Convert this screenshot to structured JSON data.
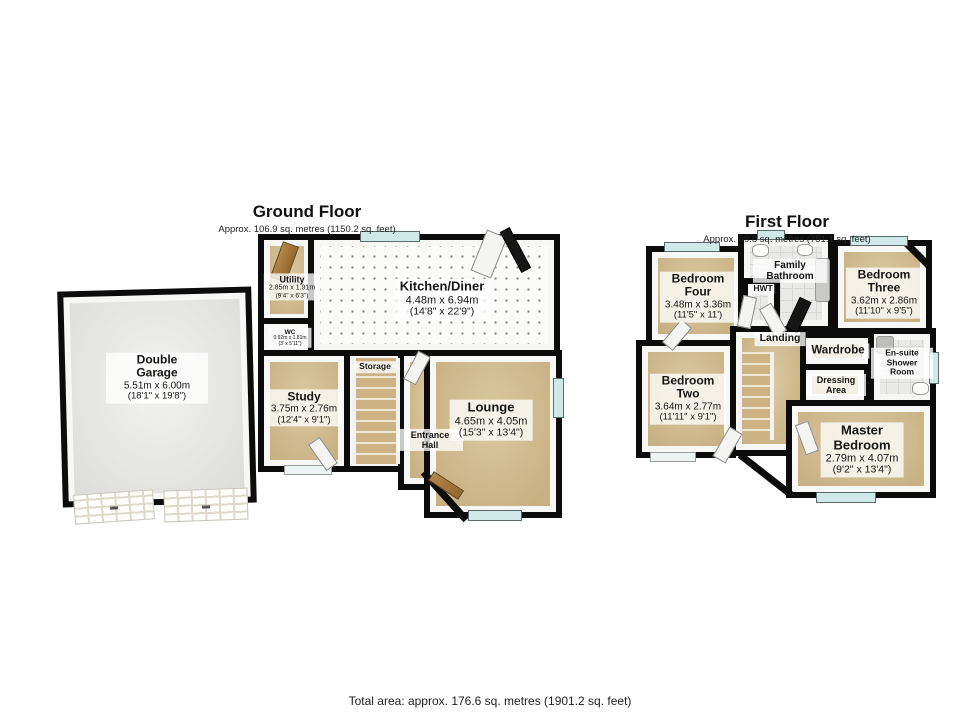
{
  "palette": {
    "wall": "#0c0c0c",
    "floor_tan": "#cbb68a",
    "floor_tile": "#e9e9e7",
    "kitchen_floor": "#fbfbf9",
    "window_glass": "#cfe9e9",
    "label_background": "#ffffff"
  },
  "ground_floor": {
    "title": "Ground Floor",
    "subtitle": "Approx. 106.9 sq. metres (1150.2 sq. feet)",
    "rooms": {
      "double_garage": {
        "name": "Double Garage",
        "metric": "5.51m x 6.00m",
        "imperial": "(18'1\" x 19'8\")"
      },
      "utility": {
        "name": "Utility",
        "metric": "2.85m x 1.91m",
        "imperial": "(9'4\" x 6'3\")"
      },
      "wc": {
        "name": "WC",
        "metric": "0.92m x 1.81m",
        "imperial": "(3' x 5'11\")"
      },
      "kitchen_diner": {
        "name": "Kitchen/Diner",
        "metric": "4.48m x 6.94m",
        "imperial": "(14'8\" x 22'9\")"
      },
      "storage": {
        "name": "Storage"
      },
      "study": {
        "name": "Study",
        "metric": "3.75m x 2.76m",
        "imperial": "(12'4\" x 9'1\")"
      },
      "entrance_hall": {
        "name": "Entrance Hall"
      },
      "lounge": {
        "name": "Lounge",
        "metric": "4.65m x 4.05m",
        "imperial": "(15'3\" x 13'4\")"
      }
    }
  },
  "first_floor": {
    "title": "First Floor",
    "subtitle": "Approx. 69.8 sq. metres (751.1 sq. feet)",
    "rooms": {
      "bedroom_four": {
        "name": "Bedroom Four",
        "metric": "3.48m x 3.36m",
        "imperial": "(11'5\" x 11')"
      },
      "family_bathroom": {
        "name": "Family Bathroom"
      },
      "hwt": {
        "name": "HWT"
      },
      "bedroom_three": {
        "name": "Bedroom Three",
        "metric": "3.62m x 2.86m",
        "imperial": "(11'10\" x 9'5\")"
      },
      "landing": {
        "name": "Landing"
      },
      "wardrobe": {
        "name": "Wardrobe"
      },
      "ensuite_shower_room": {
        "name": "En-suite Shower Room"
      },
      "dressing_area": {
        "name": "Dressing Area"
      },
      "bedroom_two": {
        "name": "Bedroom Two",
        "metric": "3.64m x 2.77m",
        "imperial": "(11'11\" x 9'1\")"
      },
      "master_bedroom": {
        "name": "Master Bedroom",
        "metric": "2.79m x 4.07m",
        "imperial": "(9'2\" x 13'4\")"
      }
    }
  },
  "footer": {
    "total_area": "Total area: approx. 176.6 sq. metres (1901.2 sq. feet)"
  }
}
